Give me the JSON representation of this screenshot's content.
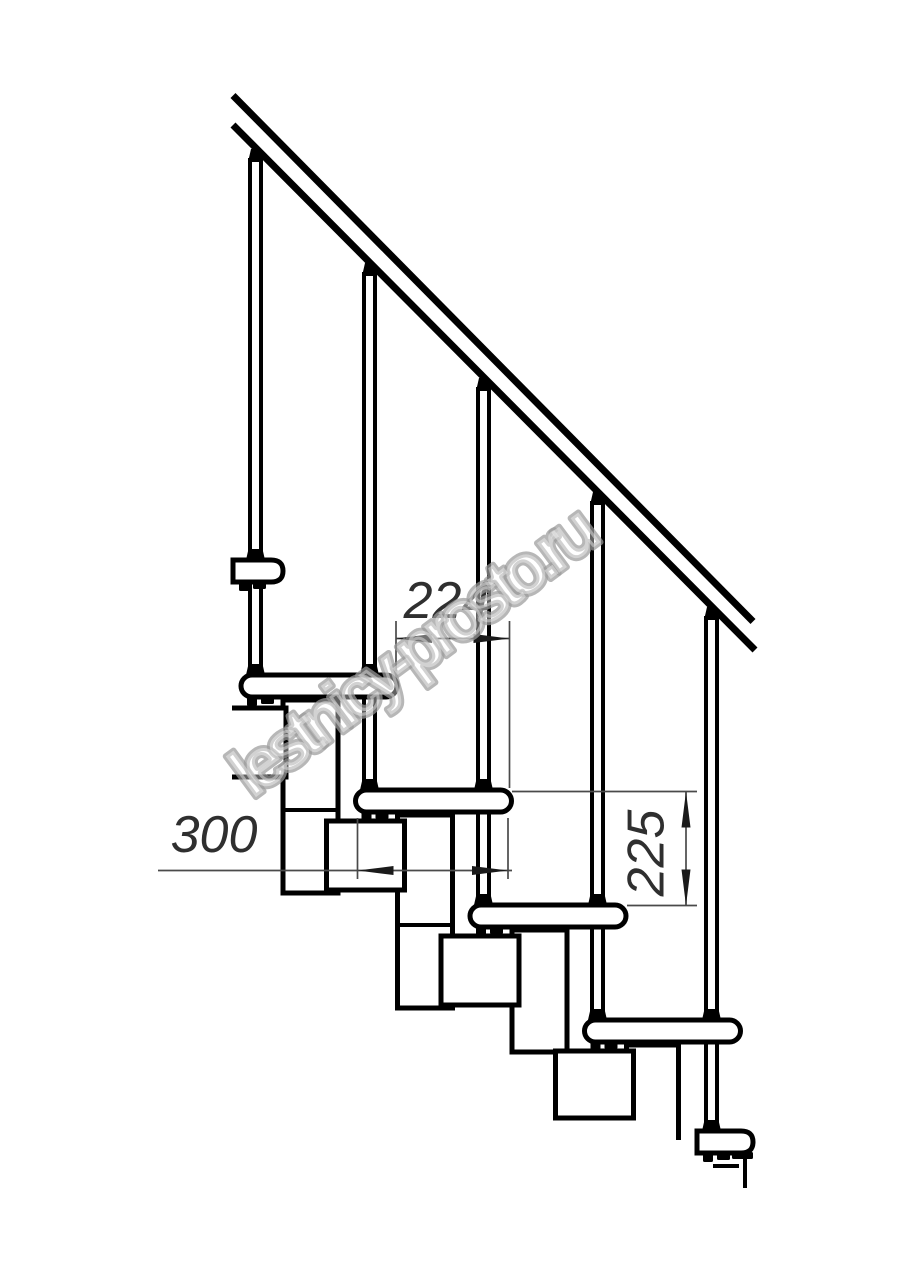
{
  "drawing": {
    "watermark_text": "lestnicy-prosto.ru",
    "dimensions": {
      "post_spacing_label": "224",
      "tread_depth_label": "300",
      "rise_height_label": "225"
    },
    "colors": {
      "line": "#000000",
      "dimension_line": "#4a4a4a",
      "dimension_text": "#2f2f2f",
      "watermark": "#9b9b9b",
      "background": "#ffffff"
    }
  }
}
